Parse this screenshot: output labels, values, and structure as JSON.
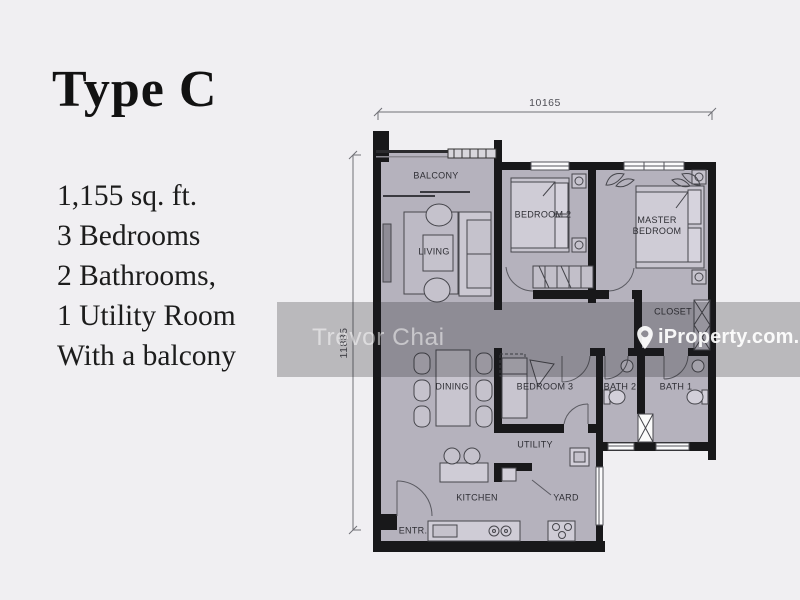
{
  "info_panel": {
    "title": "Type C",
    "specs": [
      "1,155 sq. ft.",
      "3 Bedrooms",
      "2 Bathrooms,",
      "1 Utility Room",
      "With a balcony"
    ]
  },
  "floorplan": {
    "dimensions": {
      "width_mm": "10165",
      "height_mm": "11885"
    },
    "rooms": [
      {
        "id": "balcony",
        "label": "BALCONY"
      },
      {
        "id": "living",
        "label": "LIVING"
      },
      {
        "id": "bedroom-2",
        "label": "BEDROOM 2"
      },
      {
        "id": "master-bedroom",
        "label": "MASTER BEDROOM"
      },
      {
        "id": "closet",
        "label": "CLOSET"
      },
      {
        "id": "dining",
        "label": "DINING"
      },
      {
        "id": "bedroom-3",
        "label": "BEDROOM 3"
      },
      {
        "id": "bath-2",
        "label": "BATH 2"
      },
      {
        "id": "bath-1",
        "label": "BATH 1"
      },
      {
        "id": "utility",
        "label": "UTILITY"
      },
      {
        "id": "kitchen",
        "label": "KITCHEN"
      },
      {
        "id": "yard",
        "label": "YARD"
      },
      {
        "id": "entrance",
        "label": "ENTR."
      }
    ]
  },
  "watermarks": {
    "photographer": "Trevor Chai",
    "brand": "iProperty.com.my",
    "brand_icon": "location-pin-icon"
  },
  "colors": {
    "background": "#f0eff2",
    "room_fill": "#b5b2bd",
    "wall": "#18181a",
    "watermark_band": "rgba(30,30,36,0.26)",
    "watermark_text": "#ffffff"
  }
}
